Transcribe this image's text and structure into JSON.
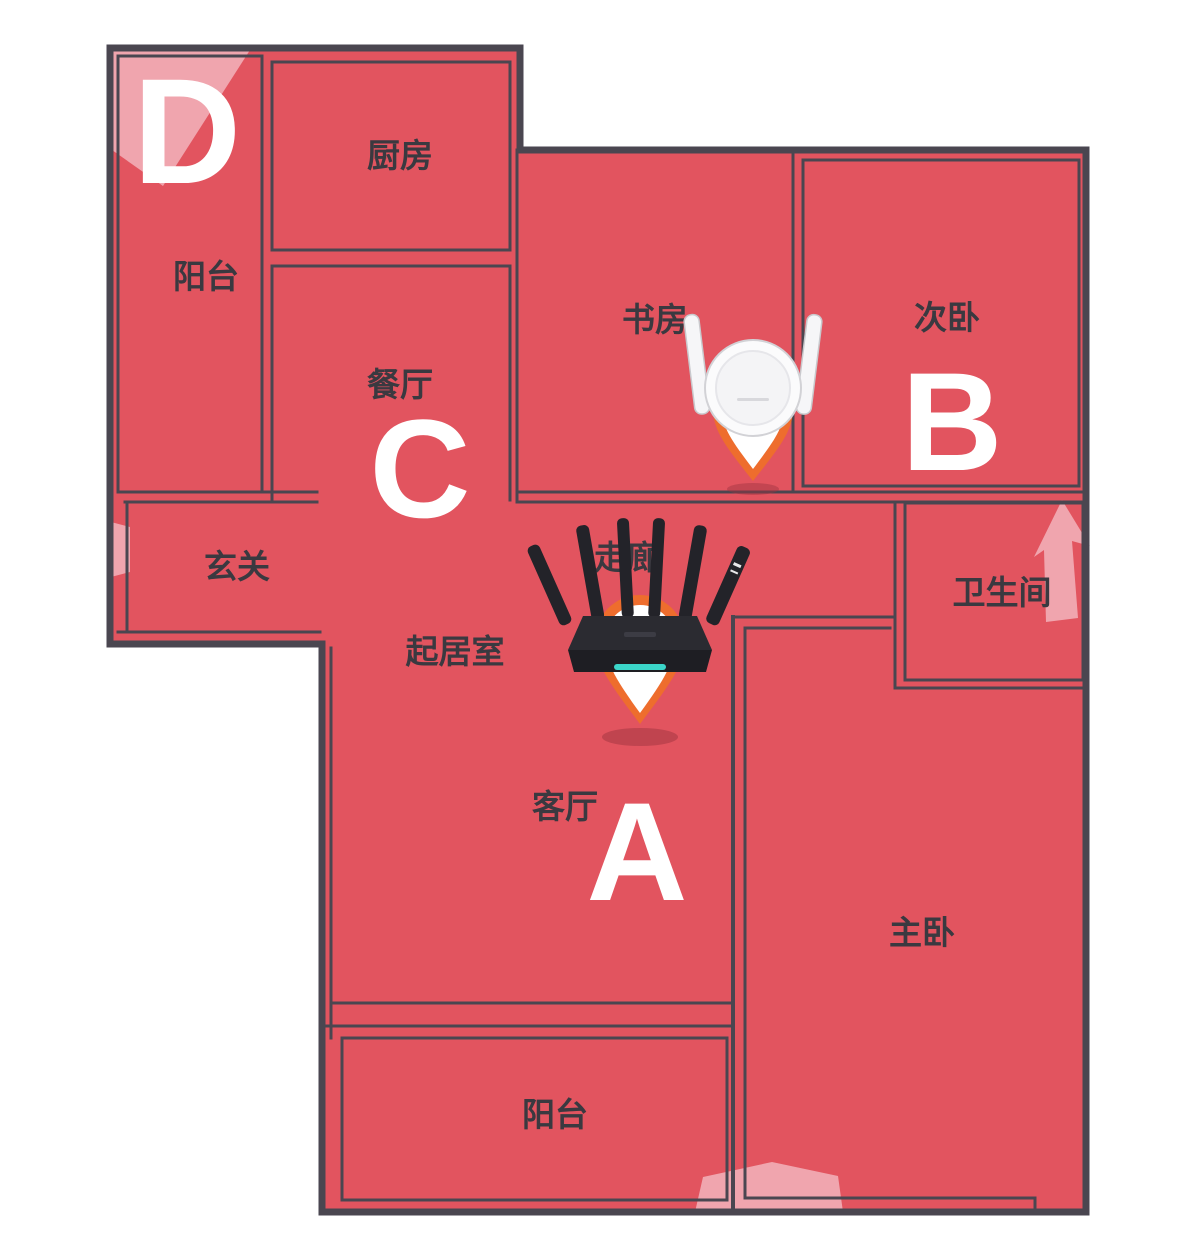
{
  "title": "WiFi coverage heatmap floor plan",
  "colors": {
    "heat_strong": "#e2545f",
    "heat_weak": "#f2aeb7",
    "wall": "#4a4650",
    "background": "#ffffff",
    "pin_orange": "#ee6d2d",
    "router_accent": "#3bd6c9",
    "label_text": "#3a3940",
    "zone_letter": "#ffffff"
  },
  "rooms": {
    "balcony_top": "阳台",
    "kitchen": "厨房",
    "dining": "餐厅",
    "study": "书房",
    "bedroom2": "次卧",
    "entry": "玄关",
    "corridor": "走廊",
    "living": "起居室",
    "bathroom": "卫生间",
    "parlor": "客厅",
    "master": "主卧",
    "balcony_bottom": "阳台"
  },
  "zones": {
    "a": "A",
    "b": "B",
    "c": "C",
    "d": "D"
  },
  "icons": {
    "router_a": "black-wifi-router",
    "router_b": "white-mesh-extender",
    "pin": "location-pin",
    "weak_signal_patch": "weak-signal-highlight"
  }
}
